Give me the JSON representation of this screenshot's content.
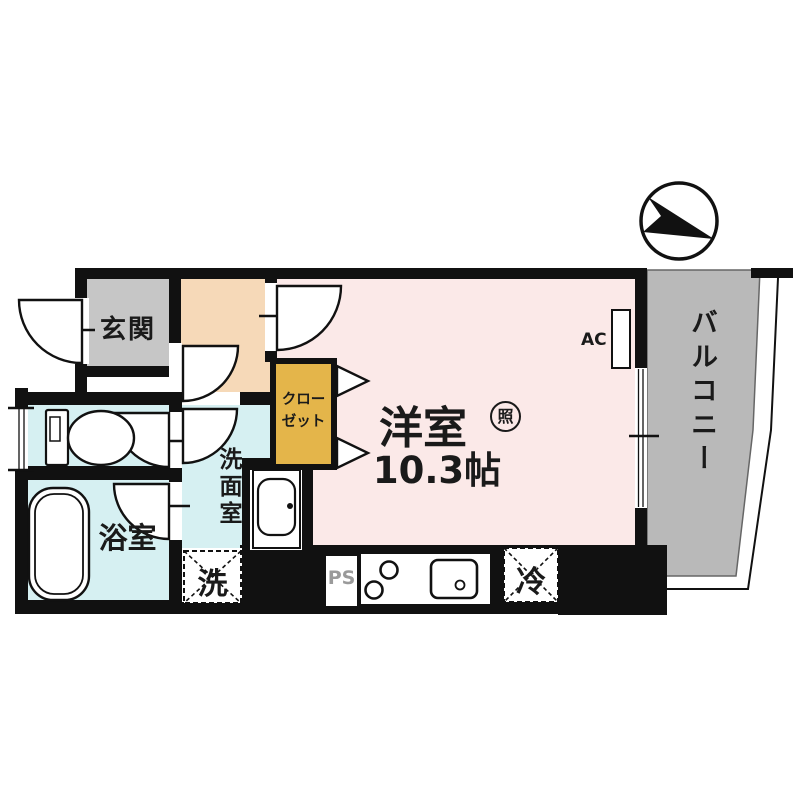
{
  "plan": {
    "title": "apartment-floor-plan",
    "compass": "north-arrow-pointing-upper-left",
    "rooms": {
      "genkan": {
        "label": "玄関"
      },
      "main_room": {
        "label": "洋室",
        "size": "10.3帖",
        "light_badge": "照",
        "ac_label": "AC"
      },
      "balcony": {
        "label": "バルコニー"
      },
      "bathroom": {
        "label": "浴室"
      },
      "washroom": {
        "label": "洗面室"
      },
      "closet": {
        "label_line1": "クロー",
        "label_line2": "ゼット"
      }
    },
    "fixtures": {
      "washer_label": "洗",
      "fridge_label": "冷",
      "pipe_space_label": "PS"
    },
    "colors": {
      "wall": "#111111",
      "main_room_fill": "#fbe9e8",
      "hallway_fill": "#f6d9b8",
      "wet_area_fill": "#d6f0f2",
      "genkan_fill": "#c6c6c6",
      "balcony_fill": "#b9b9b9",
      "closet_fill": "#e4b54a",
      "ps_text": "#9a9a9a"
    }
  }
}
